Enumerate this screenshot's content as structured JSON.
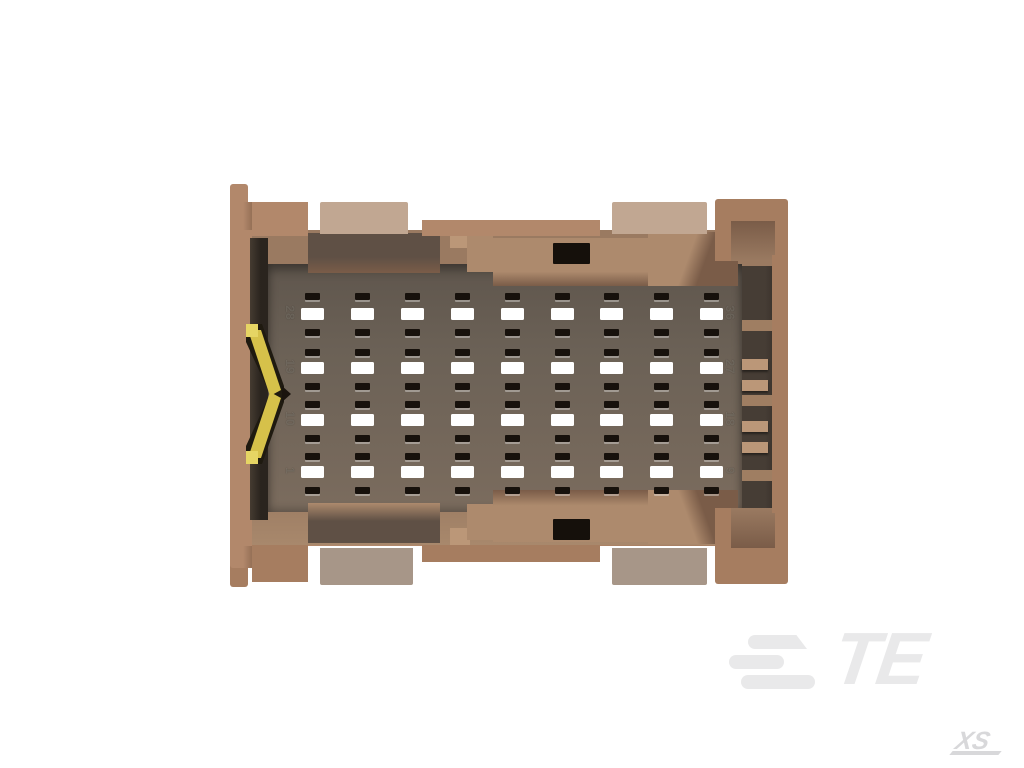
{
  "scene": {
    "description": "Top view 3D render of a tan 36-position rectangular connector housing on white background"
  },
  "colors": {
    "page_bg": "#ffffff",
    "housing_tan": "#b2886b",
    "housing_tan_dark": "#a67d60",
    "housing_shadow": "#8f6b52",
    "tab_light": "#c1a792",
    "tab_light_dark": "#a79688",
    "ledge": "#9a7a61",
    "ledge_dark": "#7a5c48",
    "ledge_lip": "#a8886c",
    "shelf_dark": "#5f5045",
    "block_tan": "#ad8a6d",
    "block_light": "#bb9778",
    "divider_tan": "#9f7e62",
    "floor_dark": "#5f564d",
    "floor_mid": "#6b6156",
    "floor_light": "#7b6c5e",
    "pocket": "#463d35",
    "channel": "#2a241e",
    "hole_black": "#15100b",
    "slot_dark": "#17110c",
    "slot_white": "#ffffff",
    "gold": "#d6c14a",
    "gold_bright": "#e6d564",
    "gold_shadow": "#1f1a10",
    "num_color": "rgba(240,230,216,0.22)",
    "logo_gray": "#e9e9ea",
    "wm_gray": "#d8d8da"
  },
  "connector": {
    "positions": 36,
    "grid": {
      "columns_x": [
        312,
        362,
        412,
        462,
        512,
        562,
        611,
        661,
        711
      ],
      "slot_width_dark": 15,
      "slot_width_white": 23,
      "rows": [
        {
          "y": 293,
          "h": 7,
          "type": "dark"
        },
        {
          "y": 308,
          "h": 12,
          "type": "white"
        },
        {
          "y": 329,
          "h": 7,
          "type": "dark"
        },
        {
          "y": 349,
          "h": 7,
          "type": "dark"
        },
        {
          "y": 362,
          "h": 12,
          "type": "white"
        },
        {
          "y": 383,
          "h": 7,
          "type": "dark"
        },
        {
          "y": 401,
          "h": 7,
          "type": "dark"
        },
        {
          "y": 414,
          "h": 12,
          "type": "white"
        },
        {
          "y": 435,
          "h": 7,
          "type": "dark"
        },
        {
          "y": 453,
          "h": 7,
          "type": "dark"
        },
        {
          "y": 466,
          "h": 12,
          "type": "white"
        },
        {
          "y": 487,
          "h": 7,
          "type": "dark"
        }
      ]
    },
    "position_labels": {
      "left": [
        "28",
        "19",
        "10",
        "1"
      ],
      "right": [
        "36",
        "27",
        "18",
        "9"
      ],
      "rows_y": [
        314,
        368,
        420,
        472
      ],
      "left_x": 290,
      "right_x": 730
    },
    "right_pockets": {
      "dividers_y": [
        320,
        395,
        470
      ],
      "tabs_y": [
        359,
        380,
        421,
        442
      ]
    }
  },
  "branding": {
    "logo_text": "TE",
    "watermark": "XS"
  }
}
